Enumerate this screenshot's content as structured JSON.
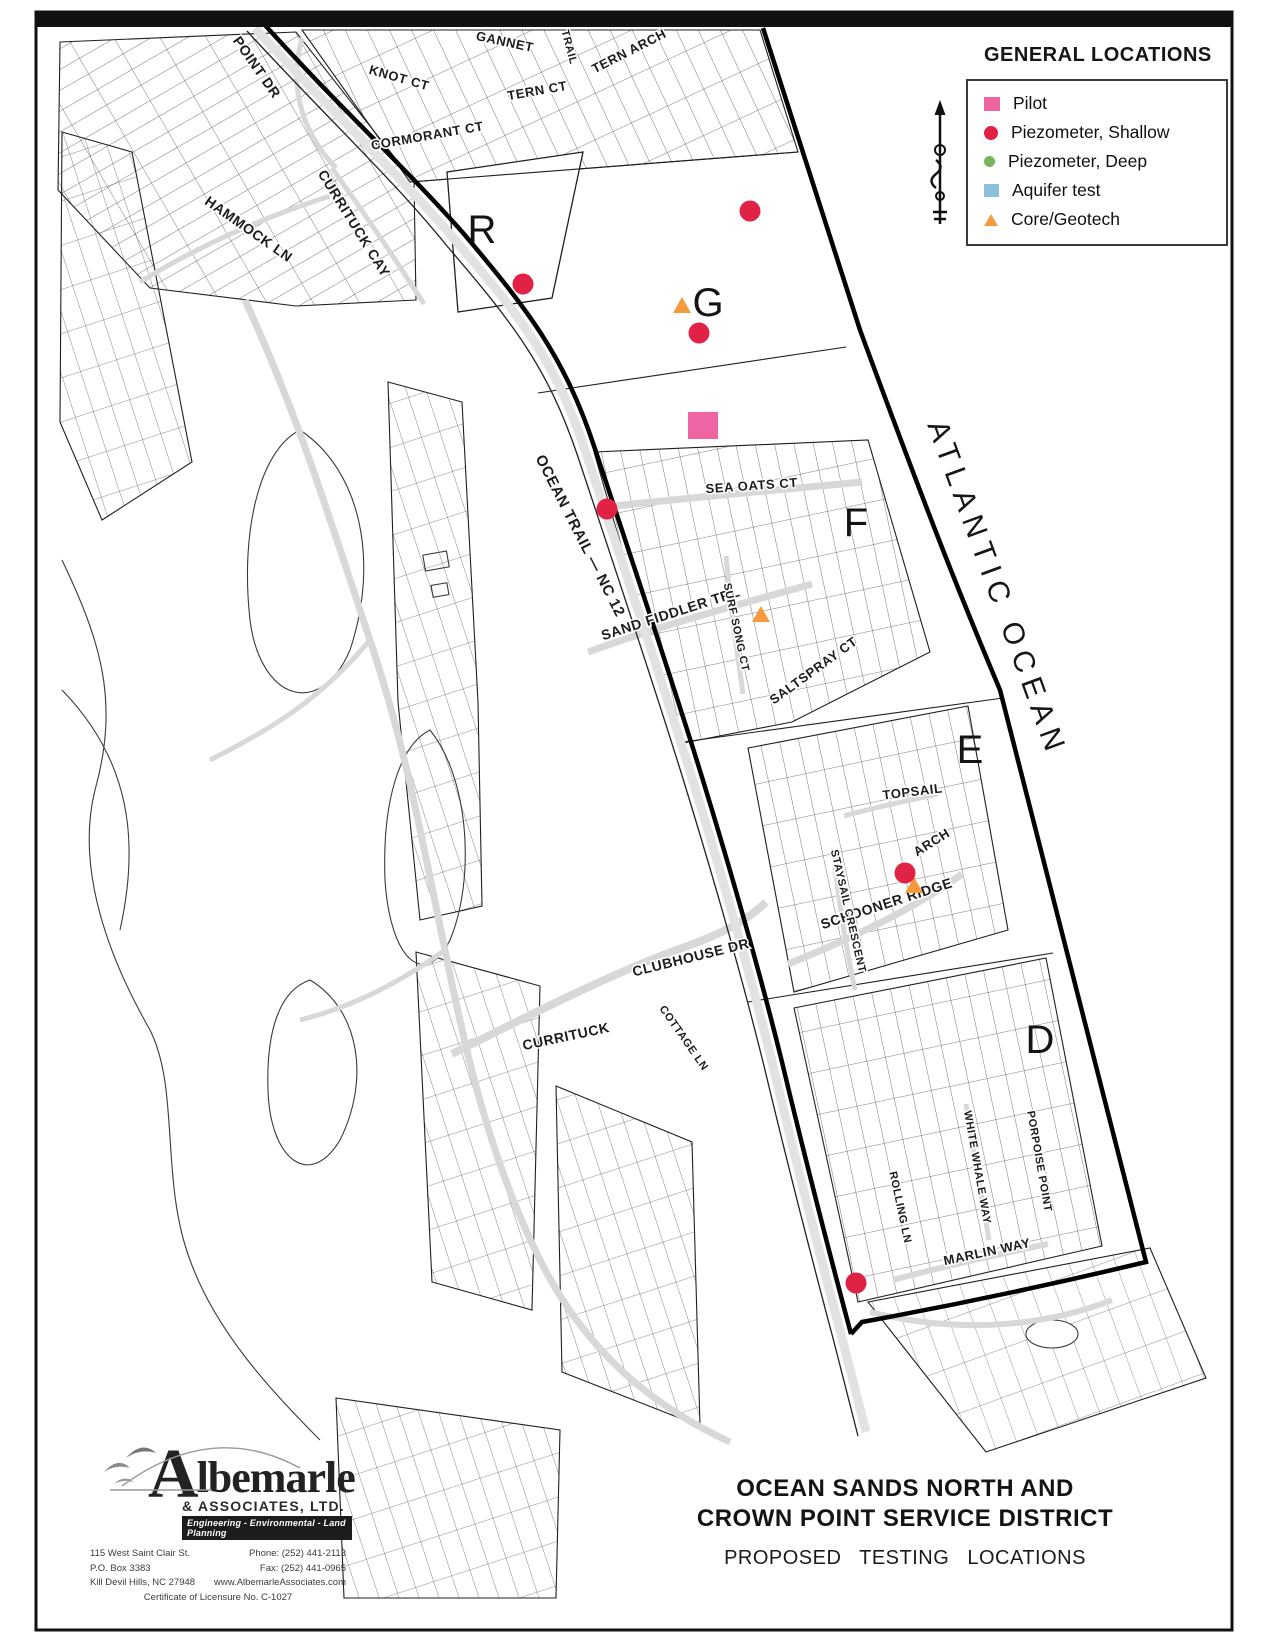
{
  "legend": {
    "title": "GENERAL LOCATIONS",
    "items": [
      {
        "id": "pilot",
        "label": "Pilot",
        "shape": "square",
        "color": "#ef64a2",
        "size": 16
      },
      {
        "id": "piezometer_shallow",
        "label": "Piezometer, Shallow",
        "shape": "circle",
        "color": "#e02246",
        "size": 14
      },
      {
        "id": "piezometer_deep",
        "label": "Piezometer, Deep",
        "shape": "circle",
        "color": "#79b55c",
        "size": 11
      },
      {
        "id": "aquifer_test",
        "label": "Aquifer test",
        "shape": "square",
        "color": "#8cbede",
        "size": 15
      },
      {
        "id": "core_geotech",
        "label": "Core/Geotech",
        "shape": "triangle",
        "color": "#f59a3d",
        "size": 13
      }
    ]
  },
  "map": {
    "ocean_label": {
      "text": "ATLANTIC OCEAN",
      "x": 988,
      "y": 592,
      "rotation": 70,
      "size": 30
    },
    "sections": [
      {
        "label": "R",
        "x": 482,
        "y": 243
      },
      {
        "label": "G",
        "x": 708,
        "y": 316
      },
      {
        "label": "F",
        "x": 856,
        "y": 536
      },
      {
        "label": "E",
        "x": 970,
        "y": 763
      },
      {
        "label": "D",
        "x": 1040,
        "y": 1053
      }
    ],
    "streets": [
      {
        "text": "POINT DR",
        "x": 253,
        "y": 70,
        "rot": 55,
        "size": 14
      },
      {
        "text": "KNOT CT",
        "x": 398,
        "y": 82,
        "rot": 16,
        "size": 13
      },
      {
        "text": "GANNET",
        "x": 504,
        "y": 46,
        "rot": 12,
        "size": 13
      },
      {
        "text": "TRAIL",
        "x": 566,
        "y": 48,
        "rot": 75,
        "size": 11
      },
      {
        "text": "TERN ARCH",
        "x": 631,
        "y": 55,
        "rot": -27,
        "size": 13
      },
      {
        "text": "TERN CT",
        "x": 538,
        "y": 95,
        "rot": -10,
        "size": 13
      },
      {
        "text": "CORMORANT CT",
        "x": 428,
        "y": 140,
        "rot": -10,
        "size": 13
      },
      {
        "text": "CURRITUCK CAY",
        "x": 350,
        "y": 226,
        "rot": 58,
        "size": 14
      },
      {
        "text": "HAMMOCK LN",
        "x": 246,
        "y": 233,
        "rot": 35,
        "size": 14
      },
      {
        "text": "OCEAN TRAIL — NC 12",
        "x": 576,
        "y": 538,
        "rot": 63,
        "size": 15
      },
      {
        "text": "SEA OATS CT",
        "x": 752,
        "y": 490,
        "rot": -4,
        "size": 13
      },
      {
        "text": "SAND FIDDLER TRL",
        "x": 672,
        "y": 618,
        "rot": -18,
        "size": 14
      },
      {
        "text": "SURF SONG CT",
        "x": 733,
        "y": 628,
        "rot": 78,
        "size": 11
      },
      {
        "text": "SALTSPRAY CT",
        "x": 816,
        "y": 674,
        "rot": -36,
        "size": 13
      },
      {
        "text": "TOPSAIL",
        "x": 913,
        "y": 796,
        "rot": -7,
        "size": 13
      },
      {
        "text": "ARCH",
        "x": 934,
        "y": 846,
        "rot": -32,
        "size": 13
      },
      {
        "text": "SCHOONER RIDGE",
        "x": 888,
        "y": 908,
        "rot": -18,
        "size": 14
      },
      {
        "text": "STAYSAIL CRESCENT",
        "x": 845,
        "y": 912,
        "rot": 77,
        "size": 11
      },
      {
        "text": "CLUBHOUSE DR",
        "x": 692,
        "y": 962,
        "rot": -14,
        "size": 14
      },
      {
        "text": "CURRITUCK",
        "x": 567,
        "y": 1041,
        "rot": -12,
        "size": 14
      },
      {
        "text": "COTTAGE LN",
        "x": 681,
        "y": 1040,
        "rot": 55,
        "size": 11
      },
      {
        "text": "ROLLING LN",
        "x": 897,
        "y": 1208,
        "rot": 78,
        "size": 11
      },
      {
        "text": "WHITE WHALE WAY",
        "x": 974,
        "y": 1168,
        "rot": 80,
        "size": 11
      },
      {
        "text": "PORPOISE POINT",
        "x": 1036,
        "y": 1162,
        "rot": 80,
        "size": 11
      },
      {
        "text": "MARLIN WAY",
        "x": 988,
        "y": 1256,
        "rot": -12,
        "size": 13
      }
    ],
    "markers": [
      {
        "type": "pilot",
        "x": 703,
        "y": 425
      },
      {
        "type": "core_geotech",
        "x": 682,
        "y": 307
      },
      {
        "type": "core_geotech",
        "x": 761,
        "y": 616
      },
      {
        "type": "core_geotech",
        "x": 914,
        "y": 887
      },
      {
        "type": "piezometer_shallow",
        "x": 523,
        "y": 284
      },
      {
        "type": "piezometer_shallow",
        "x": 750,
        "y": 211
      },
      {
        "type": "piezometer_shallow",
        "x": 699,
        "y": 333
      },
      {
        "type": "piezometer_shallow",
        "x": 607,
        "y": 509
      },
      {
        "type": "piezometer_shallow",
        "x": 905,
        "y": 873
      },
      {
        "type": "piezometer_shallow",
        "x": 856,
        "y": 1283
      }
    ]
  },
  "title_block": {
    "line1": "OCEAN SANDS NORTH AND",
    "line2": "CROWN POINT SERVICE DISTRICT",
    "subtitle": "PROPOSED TESTING LOCATIONS"
  },
  "logo": {
    "name_initial": "A",
    "name_rest": "lbemarle",
    "suffix": "& ASSOCIATES, LTD.",
    "tagline": "Engineering - Environmental - Land Planning",
    "address_line1": "115 West Saint Clair St.",
    "address_line2": "P.O. Box 3383",
    "address_line3": "Kill Devil Hills, NC 27948",
    "phone": "Phone: (252) 441-2113",
    "fax": "Fax:   (252) 441-0965",
    "website": "www.AlbemarleAssociates.com",
    "certificate": "Certificate of Licensure No. C-1027"
  }
}
